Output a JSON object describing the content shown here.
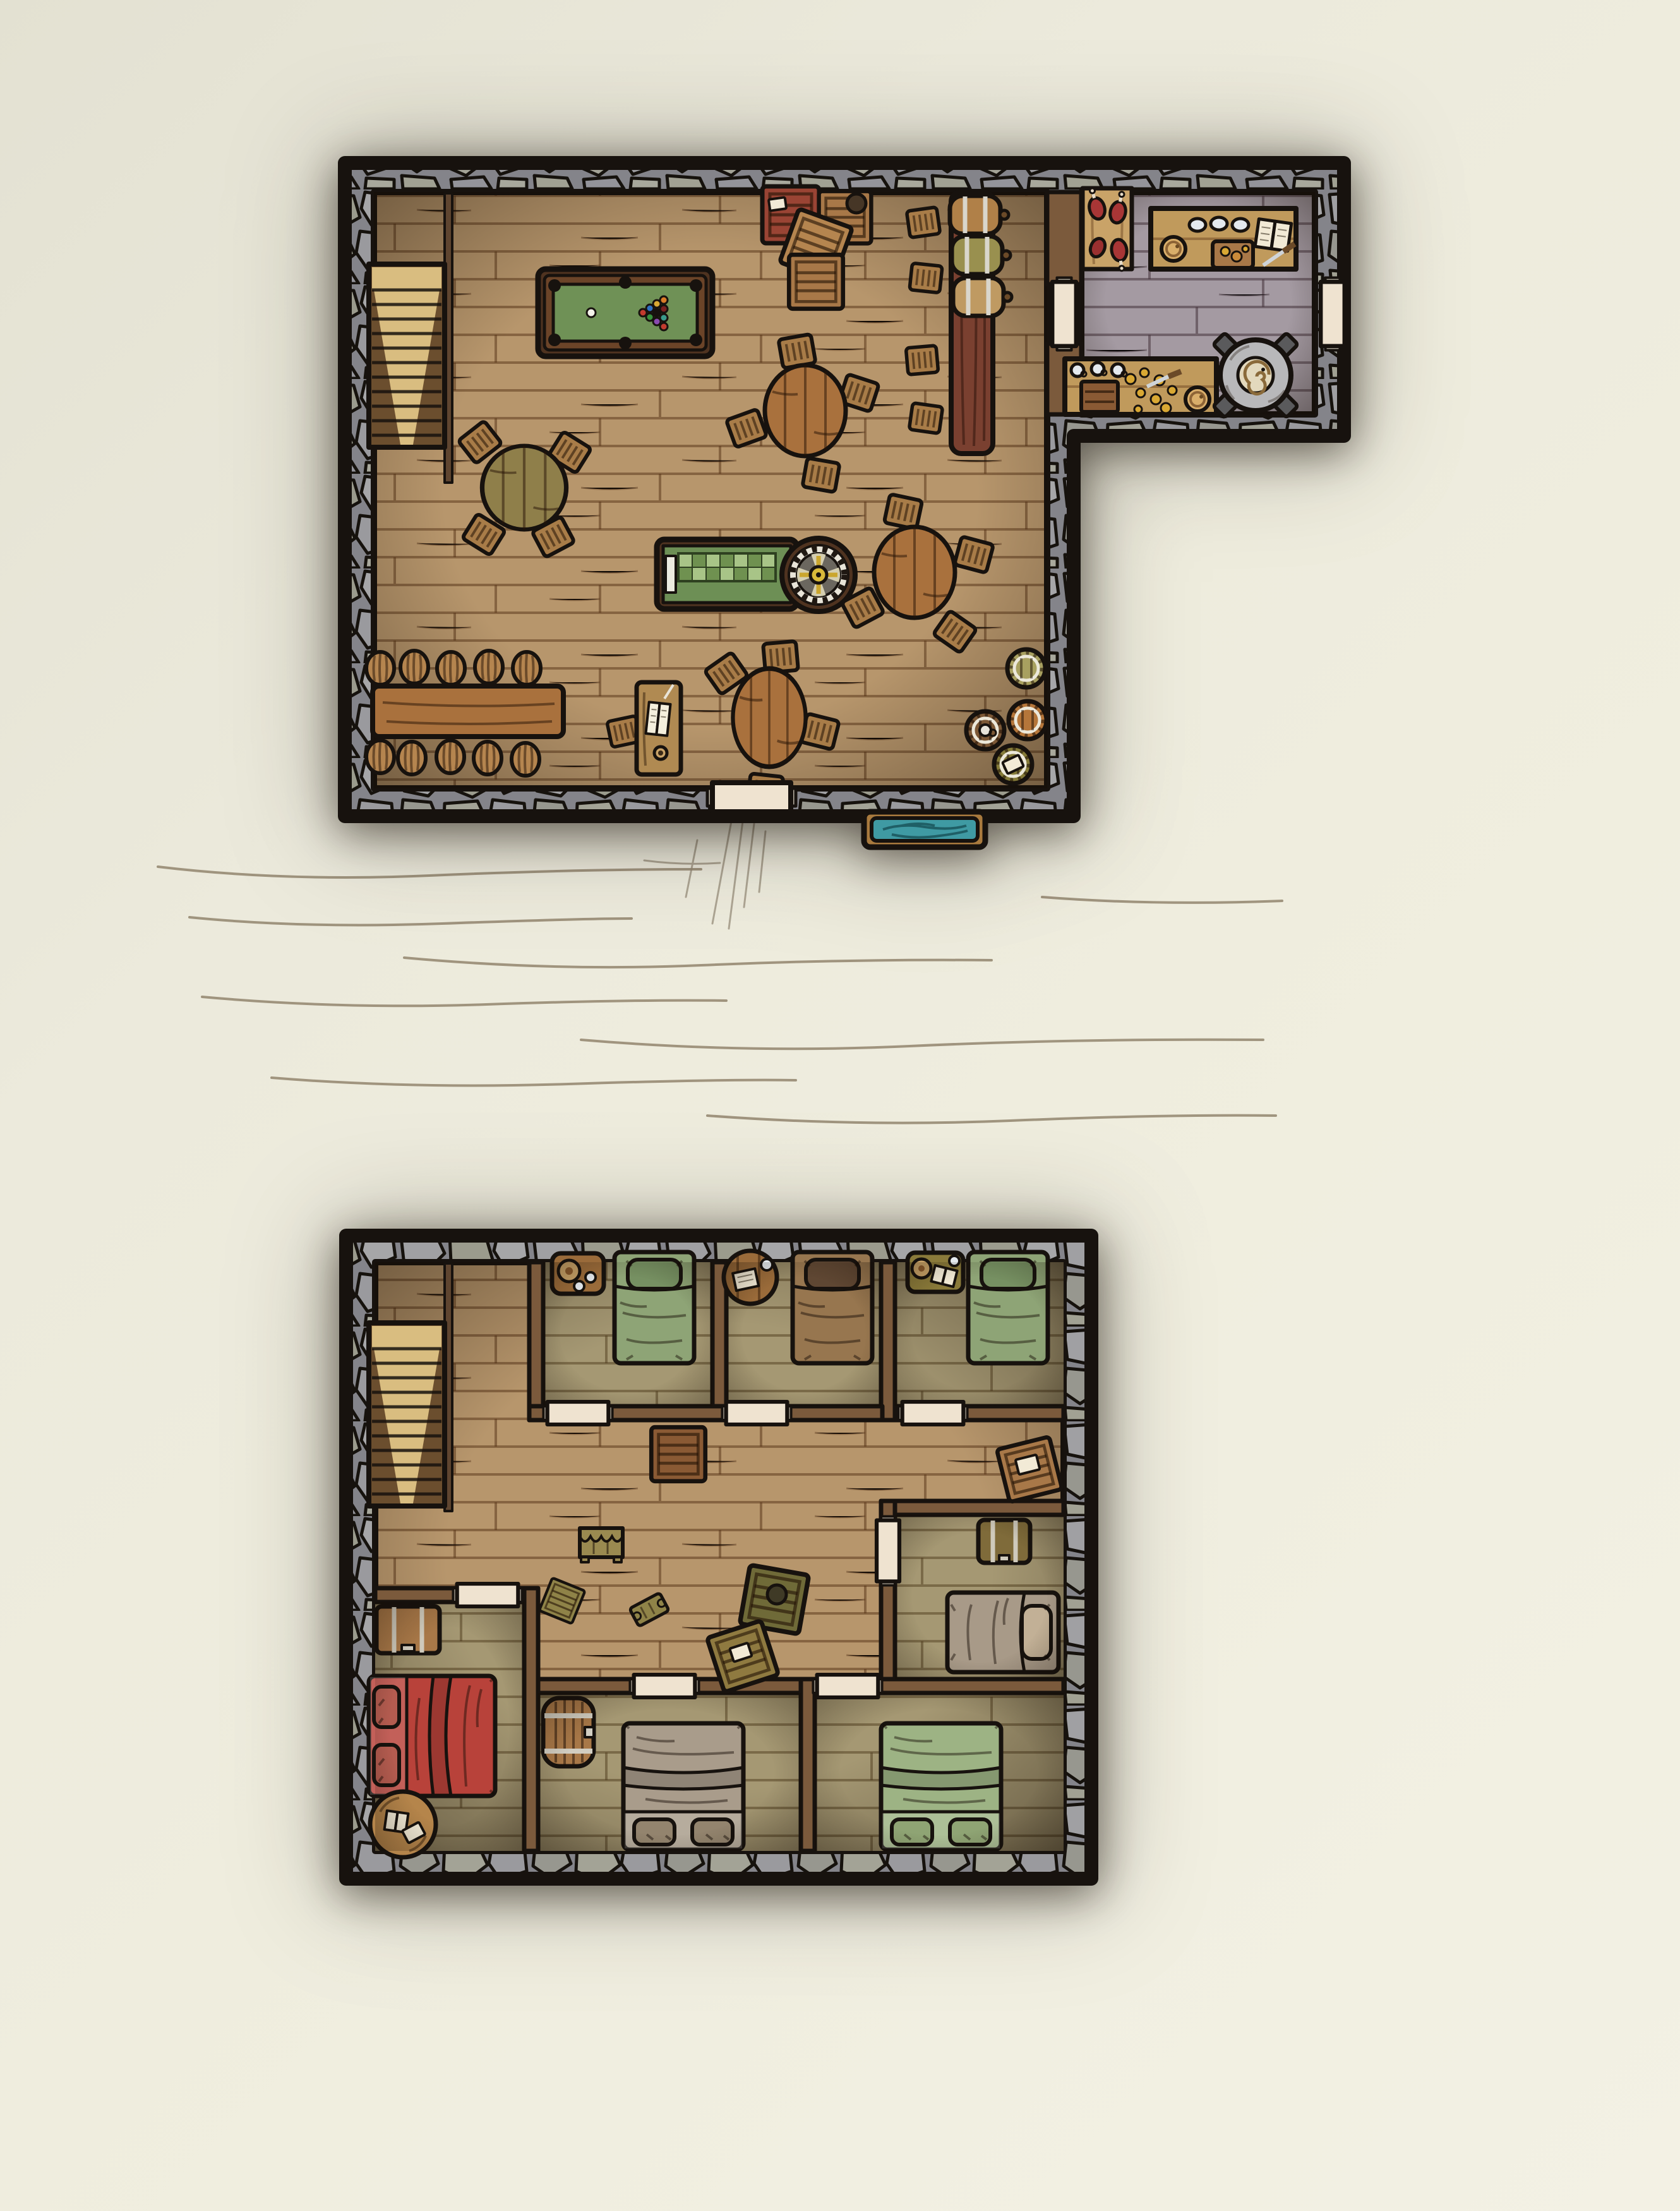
{
  "scene": {
    "kind": "hand-drawn fantasy tavern battle map, top-down view",
    "floors_shown": 2,
    "visible_text": [],
    "ground_floor": {
      "rooms": [
        {
          "name": "main hall",
          "furniture": [
            "staircase",
            "pool table with racked billiard balls and cue ball",
            "stack of four crates (one red with label)",
            "bar counter with three tapped kegs",
            "four square bar stools",
            "round table with four chairs (top)",
            "olive round table with four chairs (left)",
            "craps table with checkered felt and roulette wheel",
            "round table with four chairs (right)",
            "round table with four chairs (bottom)",
            "long table with ten round stools",
            "writing desk with open book, quill and ink",
            "four standing barrels by the wall (one with tankard, one with paper)",
            "entrance door (bottom wall)",
            "water trough outside the entrance"
          ]
        },
        {
          "name": "kitchen",
          "furniture": [
            "hanging meat board with four cuts of meat",
            "counter with three plates, round bread, cutting board, recipe book and knife",
            "prep table with three cups, small crate, scattered vegetables, knife and bread",
            "round stone stove with spiral hotplate",
            "door to main hall",
            "door to outside"
          ]
        }
      ]
    },
    "upper_floor": {
      "rooms": [
        {
          "name": "landing hallway",
          "furniture": [
            "staircase",
            "two large crates",
            "curtained stand",
            "two small crates",
            "small bench",
            "olive crate with sack",
            "tilted crate with label"
          ]
        },
        {
          "name": "bedroom 1",
          "furniture": [
            "green single bed",
            "nightstand with plate and two cups"
          ]
        },
        {
          "name": "bedroom 2",
          "furniture": [
            "brown single bed",
            "round side table with letter and cup"
          ]
        },
        {
          "name": "bedroom 3",
          "furniture": [
            "green single bed",
            "olive nightstand with plate, book and cup"
          ]
        },
        {
          "name": "bedroom 4",
          "furniture": [
            "banded chest",
            "gray single bed with tan pillow"
          ]
        },
        {
          "name": "red bedroom",
          "furniture": [
            "red double bed",
            "banded chest",
            "round rug with two books"
          ]
        },
        {
          "name": "bedroom 6",
          "furniture": [
            "barrel cabinet",
            "gray double bed"
          ]
        },
        {
          "name": "bedroom 7",
          "furniture": [
            "green double bed"
          ]
        }
      ]
    }
  },
  "palette": {
    "outline": "#17120e",
    "stone": "#8e8e91",
    "floor_wood": "#b7966c",
    "floor_kitchen": "#a49aa2",
    "floor_bedroom": "#a59873",
    "wall_wood": "#7b5a3c",
    "door_cream": "#efe3d0",
    "pool_felt": "#6f9156",
    "pool_frame": "#4f3320",
    "craps_felt": "#6d8f55",
    "checker_light": "#a8c487",
    "checker_dark": "#6f9150",
    "wheel_hub": "#d8b93a",
    "bar_wood": "#7a4030",
    "table_wood": "#a9713d",
    "table_olive": "#8f7f4a",
    "chair_wood": "#a87c48",
    "stool_wood": "#b5854f",
    "crate_wood": "#a87848",
    "crate_red": "#9a4434",
    "crate_olive": "#8f8348",
    "bed_green": "#8ea476",
    "bed_brown": "#97764f",
    "bed_red": "#b8423a",
    "bed_gray": "#a99c8b",
    "water_teal": "#3f9aa3",
    "trough_wood": "#a97a3e",
    "stairs_light": "#d9bd80",
    "stairs_dark": "#6b4e2e",
    "stove_gray": "#b8b8ba",
    "meat_red": "#a83636",
    "paper": "#f2ead6",
    "ground_line": "#8d7f67"
  }
}
